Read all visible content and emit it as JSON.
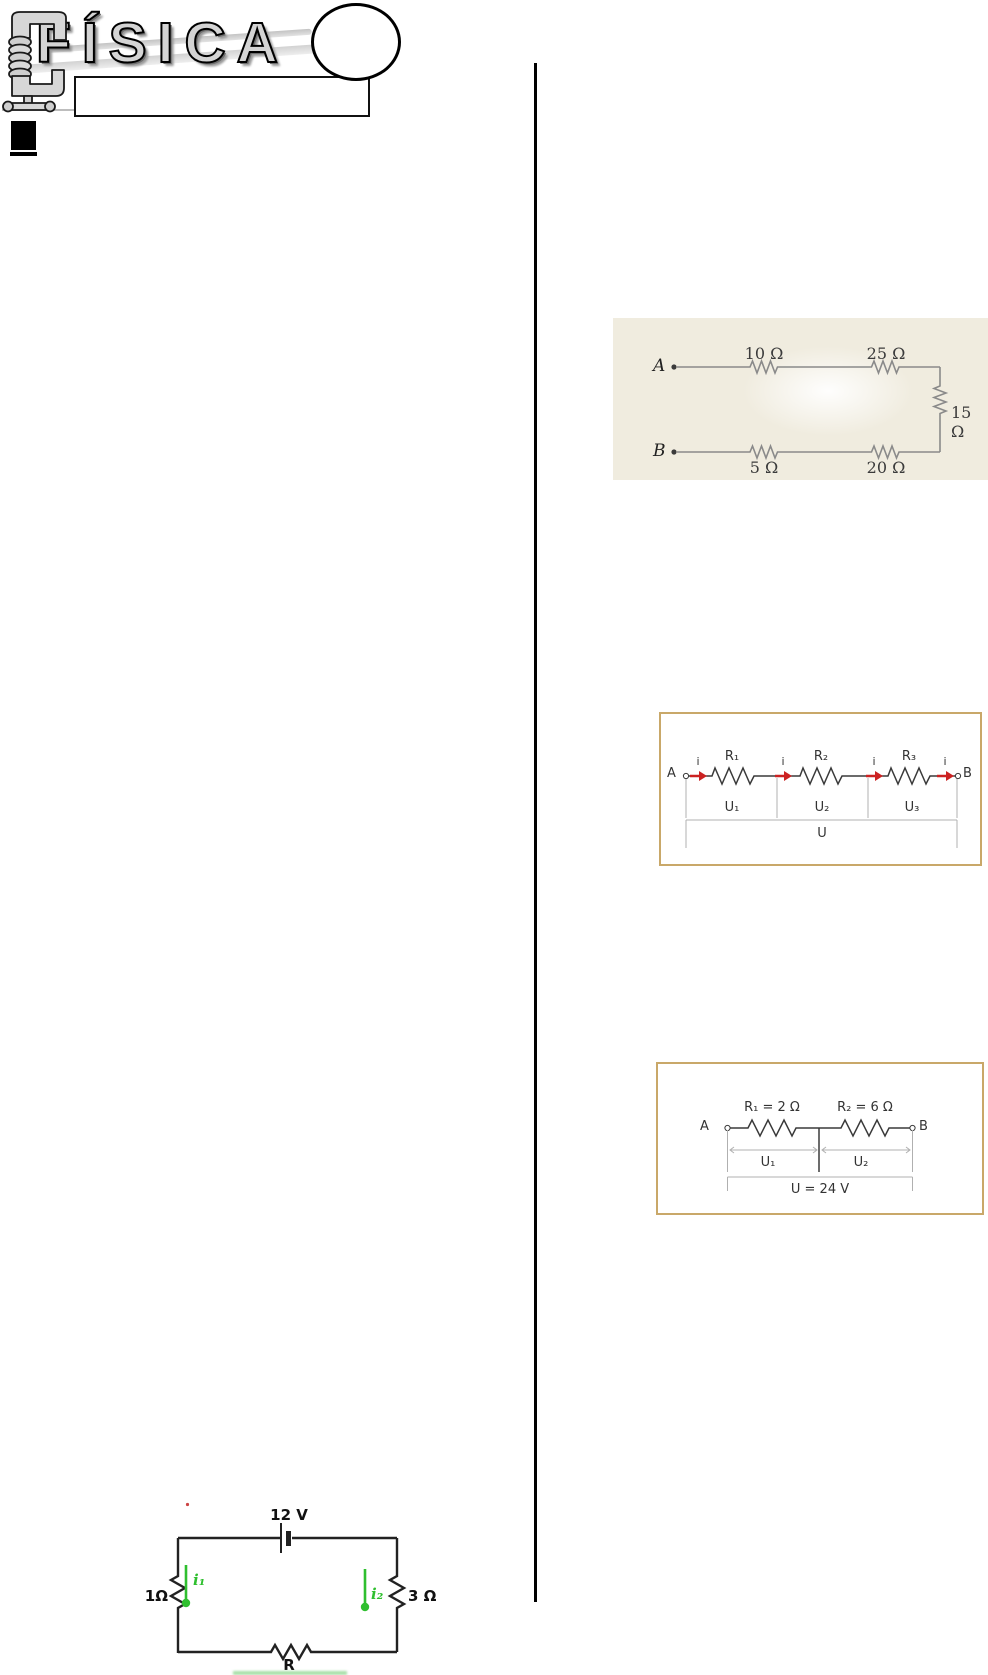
{
  "header": {
    "title": "FÍSICA"
  },
  "circuit_parallel": {
    "node_a": "A",
    "node_b": "B",
    "r_top_left": "10 Ω",
    "r_top_right": "25 Ω",
    "r_right": "15 Ω",
    "r_bottom_left": "5 Ω",
    "r_bottom_right": "20 Ω"
  },
  "circuit_series": {
    "node_a": "A",
    "node_b": "B",
    "current": "i",
    "r1": "R₁",
    "r2": "R₂",
    "r3": "R₃",
    "u1": "U₁",
    "u2": "U₂",
    "u3": "U₃",
    "u_total": "U"
  },
  "circuit_series_values": {
    "node_a": "A",
    "node_b": "B",
    "r1": "R₁ = 2 Ω",
    "r2": "R₂ = 6 Ω",
    "u1": "U₁",
    "u2": "U₂",
    "u_total": "U = 24 V"
  },
  "circuit_battery": {
    "battery": "12 V",
    "r_left": "1Ω",
    "r_right": "3 Ω",
    "r_bottom": "R",
    "i1": "i₁",
    "i2": "i₂"
  },
  "colors": {
    "figure_box_border": "#c9a869",
    "current_arrow_red": "#cc2222",
    "current_green": "#2fbf2f",
    "scan_background": "#f0ecdf"
  }
}
